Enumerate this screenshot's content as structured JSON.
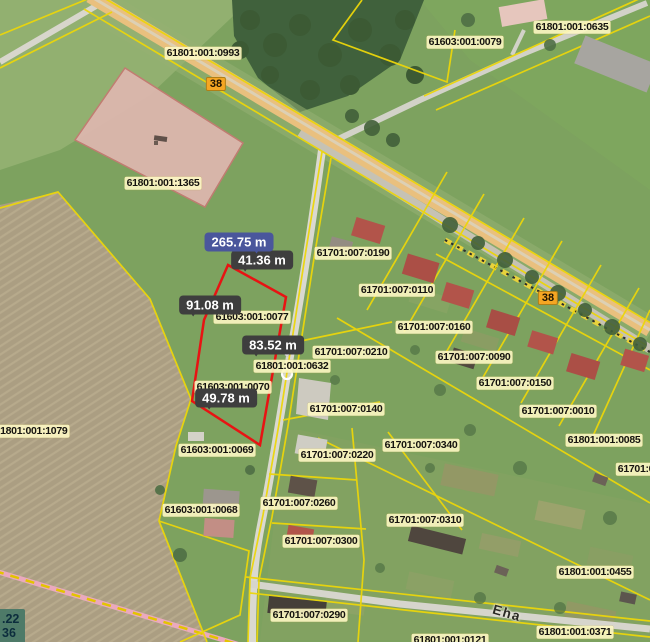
{
  "map": {
    "title": "cadastral-aerial-map",
    "measurement": {
      "total": {
        "label": "265.75 m",
        "x": 239,
        "y": 242
      },
      "segments": [
        {
          "label": "41.36 m",
          "x": 262,
          "y": 260
        },
        {
          "label": "91.08 m",
          "x": 210,
          "y": 305
        },
        {
          "label": "83.52 m",
          "x": 273,
          "y": 345
        },
        {
          "label": "49.78 m",
          "x": 226,
          "y": 398
        }
      ]
    },
    "parcel_labels": [
      {
        "code": "61801:001:0993",
        "x": 203,
        "y": 53
      },
      {
        "code": "61603:001:0079",
        "x": 465,
        "y": 42
      },
      {
        "code": "61801:001:0635",
        "x": 572,
        "y": 27
      },
      {
        "code": "61801:001:1365",
        "x": 163,
        "y": 183
      },
      {
        "code": "61701:007:0190",
        "x": 353,
        "y": 253
      },
      {
        "code": "61701:007:0110",
        "x": 397,
        "y": 290
      },
      {
        "code": "61701:007:0160",
        "x": 434,
        "y": 327
      },
      {
        "code": "61701:007:0210",
        "x": 351,
        "y": 352
      },
      {
        "code": "61801:001:0632",
        "x": 292,
        "y": 366
      },
      {
        "code": "61603:001:0077",
        "x": 252,
        "y": 317
      },
      {
        "code": "61701:007:0090",
        "x": 474,
        "y": 357
      },
      {
        "code": "61701:007:0150",
        "x": 515,
        "y": 383
      },
      {
        "code": "61603:001:0070",
        "x": 233,
        "y": 387
      },
      {
        "code": "61701:007:0140",
        "x": 346,
        "y": 409
      },
      {
        "code": "61701:007:0010",
        "x": 558,
        "y": 411
      },
      {
        "code": "61801:001:1079",
        "x": 31,
        "y": 431
      },
      {
        "code": "61801:001:0085",
        "x": 604,
        "y": 440
      },
      {
        "code": "61701:007:0340",
        "x": 421,
        "y": 445
      },
      {
        "code": "61603:001:0069",
        "x": 217,
        "y": 450
      },
      {
        "code": "61701:007:0220",
        "x": 337,
        "y": 455
      },
      {
        "code": "61701:0",
        "x": 636,
        "y": 469
      },
      {
        "code": "61701:007:0260",
        "x": 299,
        "y": 503
      },
      {
        "code": "61603:001:0068",
        "x": 201,
        "y": 510
      },
      {
        "code": "61701:007:0310",
        "x": 425,
        "y": 520
      },
      {
        "code": "61701:007:0300",
        "x": 321,
        "y": 541
      },
      {
        "code": "61801:001:0455",
        "x": 595,
        "y": 572
      },
      {
        "code": "61701:007:0290",
        "x": 309,
        "y": 615
      },
      {
        "code": "61801:001:0371",
        "x": 575,
        "y": 632
      },
      {
        "code": "61801:001:0121",
        "x": 450,
        "y": 640
      }
    ],
    "road_badges": [
      {
        "number": "38",
        "x": 216,
        "y": 84
      },
      {
        "number": "38",
        "x": 548,
        "y": 298
      }
    ],
    "street_label": {
      "name": "Eha",
      "x": 507,
      "y": 613
    },
    "corner_readout": {
      "line1": ".22",
      "line2": "36"
    },
    "colors": {
      "measure_polygon_red": "#e81313",
      "boundary_yellow": "#ecd60a",
      "road_badge_orange": "#f5a623",
      "label_cream": "#fdf6c4",
      "badge_dark": "#3e3e3e",
      "badge_total_blue": "#4a569c"
    }
  }
}
